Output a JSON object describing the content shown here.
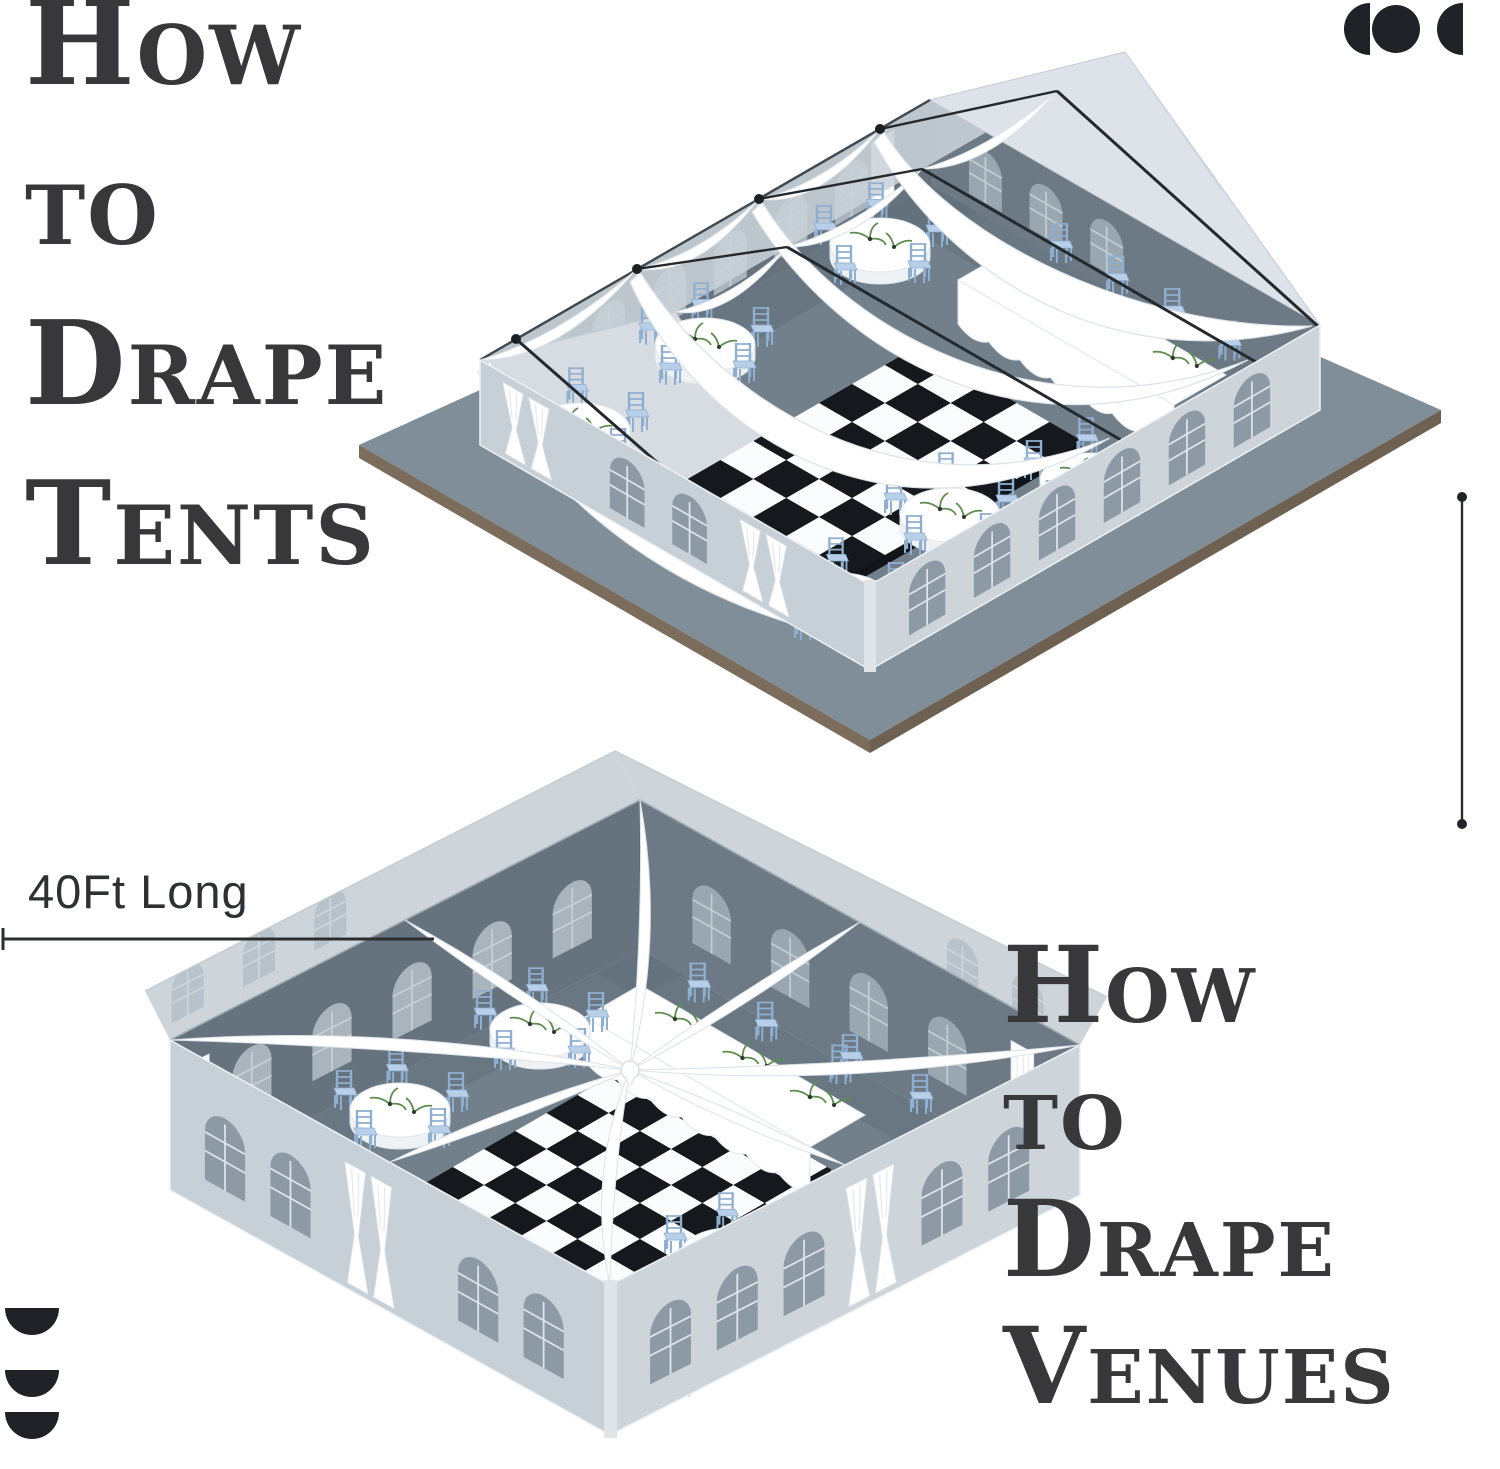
{
  "page": {
    "width_px": 1500,
    "height_px": 1469,
    "background_color": "#ffffff"
  },
  "headings": {
    "tents": {
      "text": "How to Drape Tents",
      "lines": [
        "How",
        "to",
        "Drape",
        "Tents"
      ],
      "color": "#38383a"
    },
    "venues": {
      "text": "How to Drape Venues",
      "lines": [
        "How",
        "to",
        "Drape",
        "Venues"
      ],
      "color": "#38383a"
    }
  },
  "dimension": {
    "label": "40Ft Long",
    "color": "#2e3033"
  },
  "decorations": {
    "top_right_icon": "three-circle-crescent-mark",
    "bottom_left_icon": "stacked-half-circles-mark",
    "right_rule": "vertical-line-with-end-dots",
    "icon_color": "#1f2226"
  },
  "illustrations": {
    "top": {
      "name": "draped-frame-tent-isometric",
      "objects": [
        "swag-drapes",
        "ridge-beams",
        "checkerboard-dance-floor",
        "round-banquet-tables",
        "long-banquet-table",
        "chiavari-chairs",
        "arched-windows",
        "tied-entrance-curtains"
      ]
    },
    "bottom": {
      "name": "draped-open-venue-isometric",
      "objects": [
        "radial-ceiling-drapes",
        "checkerboard-dance-floor",
        "round-banquet-tables",
        "long-banquet-table",
        "chiavari-chairs",
        "arched-windows",
        "tied-entrance-curtains"
      ]
    }
  },
  "palette": {
    "wall_light": "#c7d0d7",
    "wall_lighter": "#cdd5db",
    "gable": "#dde3e8",
    "gable_left": "#d6dce2",
    "roof_tint": "#c9d1d8",
    "wall_dark": "#66737e",
    "wall_dark2": "#6d7a85",
    "floor": "#72808c",
    "floor_shadow": "#5f6d78",
    "platform": "#7f8e99",
    "platform_edge_brown": "#7b6c5c",
    "window_ext": "#8d9aa6",
    "window_int": "#a9b4bd",
    "window_ghost": "#b8c2ca",
    "frame": "#dfe4e9",
    "chair_blue": "#b7cfe8",
    "chair_line": "#8fafd0",
    "cloth": "#ffffff",
    "cloth_shade": "#eff2f5",
    "checker_dark": "#15181c",
    "checker_light": "#fbfcfd",
    "drape_edge": "#dce2e7",
    "beam": "#24292e",
    "greenery": "#5d8c4e"
  }
}
